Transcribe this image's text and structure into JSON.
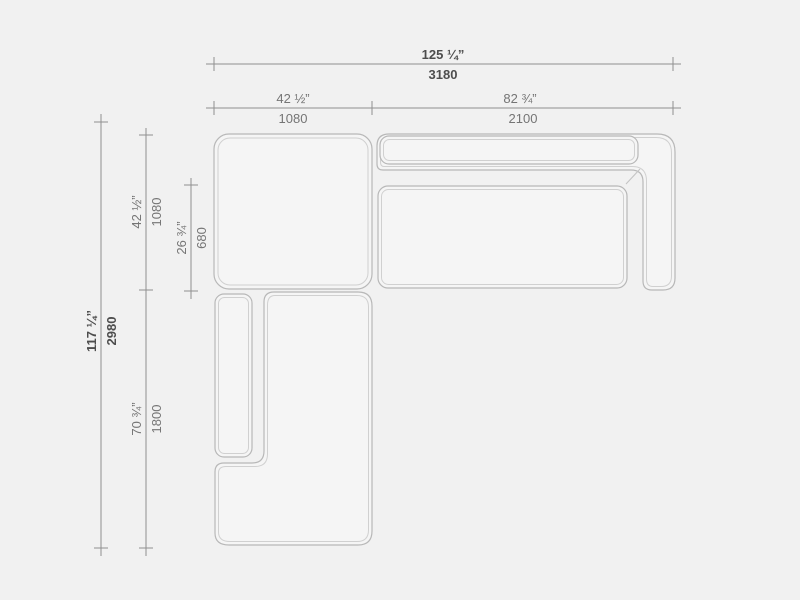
{
  "drawing": {
    "kind": "sectional-sofa-plan-view",
    "background": "#f1f1f1",
    "colors": {
      "module_fill": "#f5f5f5",
      "module_outline": "#b8b8b8",
      "module_inner_line": "#d0d0d0",
      "dimension_line": "#8f8f8f",
      "dimension_text": "#757575",
      "dimension_text_bold": "#4d4d4d"
    },
    "dimensions": {
      "overall_width": {
        "imperial": "125 ¼”",
        "metric": "3180"
      },
      "left_module_width": {
        "imperial": "42 ½”",
        "metric": "1080"
      },
      "right_module_width": {
        "imperial": "82 ¾”",
        "metric": "2100"
      },
      "overall_depth": {
        "imperial": "117 ¼”",
        "metric": "2980"
      },
      "top_module_depth": {
        "imperial": "42 ½”",
        "metric": "1080"
      },
      "seat_depth": {
        "imperial": "26 ¾”",
        "metric": "680"
      },
      "bottom_module_length": {
        "imperial": "70 ¾”",
        "metric": "1800"
      }
    }
  }
}
